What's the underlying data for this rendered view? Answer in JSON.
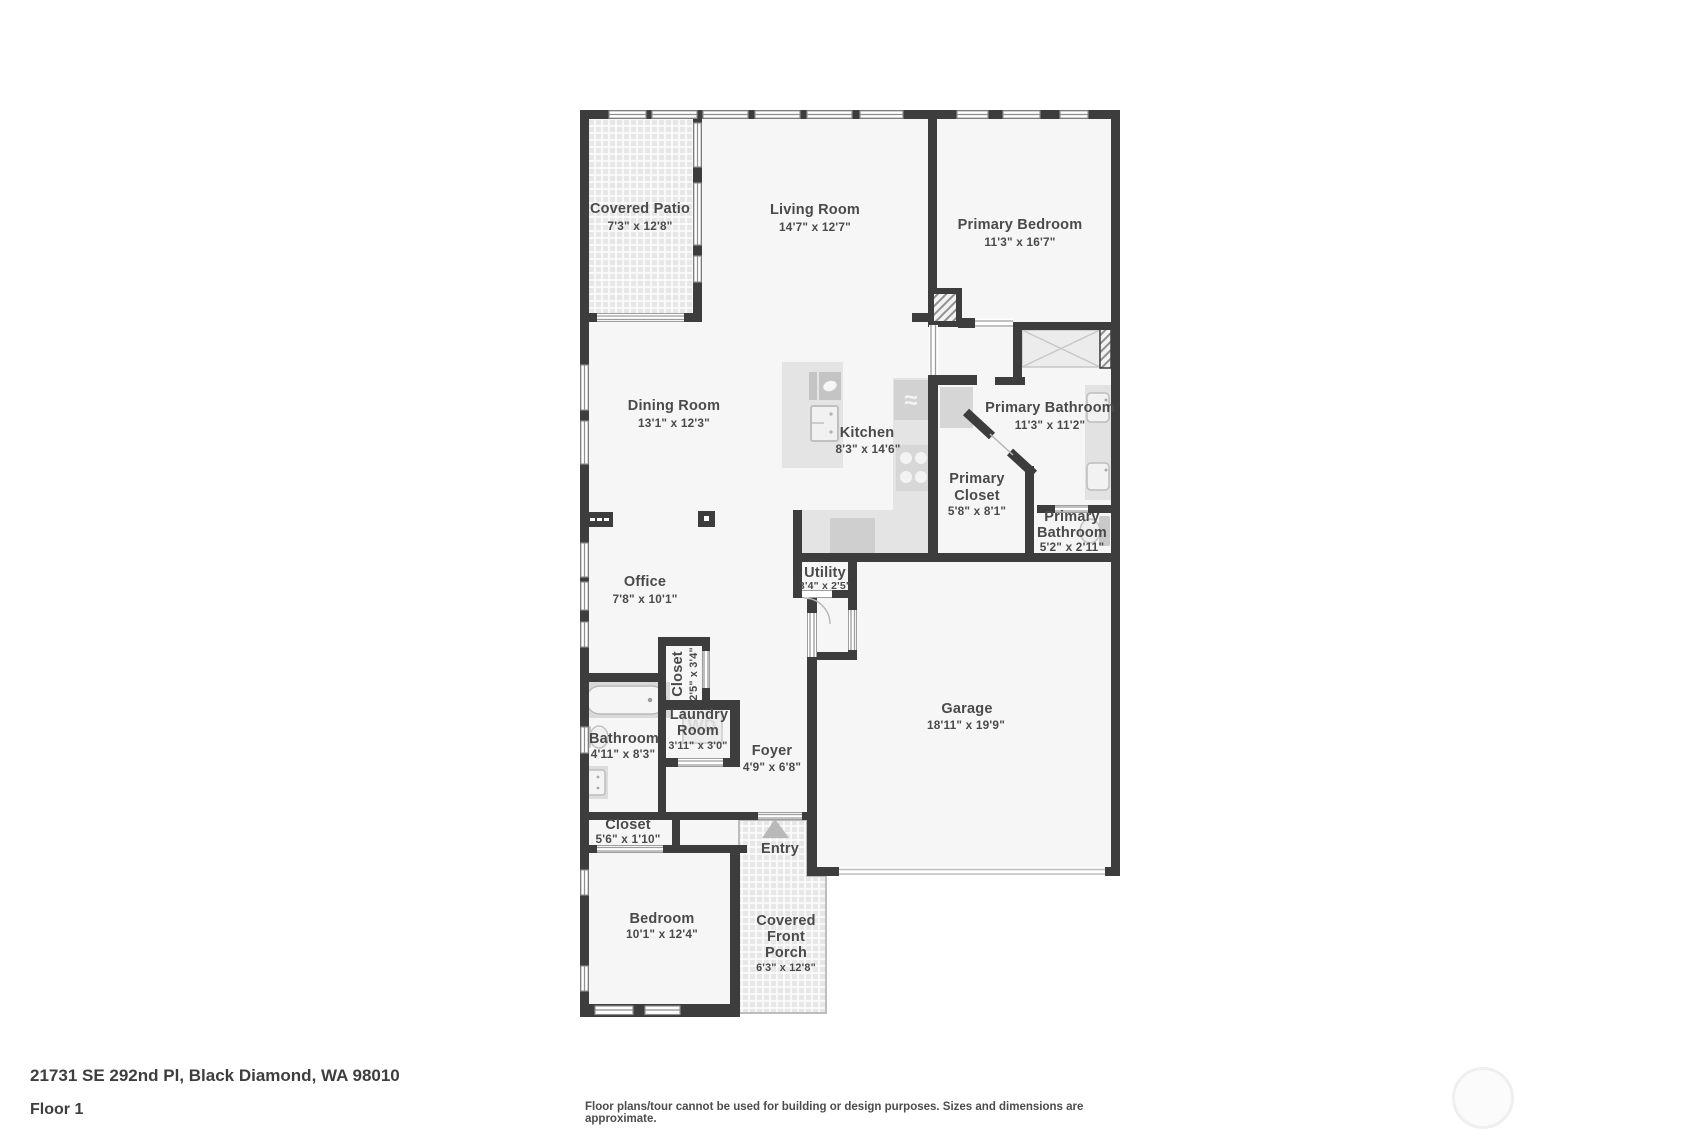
{
  "floorplan": {
    "wall_color": "#3d3d3d",
    "room_fill": "#f6f6f6",
    "label_color": "#4a4a4a",
    "rooms": {
      "covered_patio": {
        "name": "Covered Patio",
        "dims": "7'3\" x 12'8\""
      },
      "living_room": {
        "name": "Living Room",
        "dims": "14'7\" x 12'7\""
      },
      "primary_bedroom": {
        "name": "Primary Bedroom",
        "dims": "11'3\" x 16'7\""
      },
      "dining_room": {
        "name": "Dining Room",
        "dims": "13'1\" x 12'3\""
      },
      "kitchen": {
        "name": "Kitchen",
        "dims": "8'3\" x 14'6\""
      },
      "primary_bathroom": {
        "name": "Primary Bathroom",
        "dims": "11'3\" x 11'2\""
      },
      "primary_closet": {
        "line1": "Primary",
        "line2": "Closet",
        "dims": "5'8\" x 8'1\""
      },
      "primary_bathroom_2": {
        "line1": "Primary",
        "line2": "Bathroom",
        "dims": "5'2\" x 2'11\""
      },
      "utility": {
        "name": "Utility",
        "dims": "3'4\" x 2'5\""
      },
      "office": {
        "name": "Office",
        "dims": "7'8\" x 10'1\""
      },
      "closet": {
        "name": "Closet",
        "dims": "2'5\" x 3'4\""
      },
      "laundry_room": {
        "line1": "Laundry",
        "line2": "Room",
        "dims": "3'11\" x 3'0\""
      },
      "bathroom": {
        "name": "Bathroom",
        "dims": "4'11\" x 8'3\""
      },
      "foyer": {
        "name": "Foyer",
        "dims": "4'9\" x 6'8\""
      },
      "garage": {
        "name": "Garage",
        "dims": "18'11\" x 19'9\""
      },
      "closet_2": {
        "name": "Closet",
        "dims": "5'6\" x 1'10\""
      },
      "bedroom": {
        "name": "Bedroom",
        "dims": "10'1\" x 12'4\""
      },
      "entry": {
        "name": "Entry"
      },
      "covered_front_porch": {
        "line1": "Covered",
        "line2": "Front",
        "line3": "Porch",
        "dims": "6'3\" x 12'8\""
      }
    },
    "fixtures": {
      "washer_dryer": "WD"
    }
  },
  "footer": {
    "address": "21731 SE 292nd Pl, Black Diamond, WA 98010",
    "floor_label": "Floor 1",
    "disclaimer": "Floor plans/tour cannot be used for building or design purposes. Sizes and dimensions are approximate."
  }
}
